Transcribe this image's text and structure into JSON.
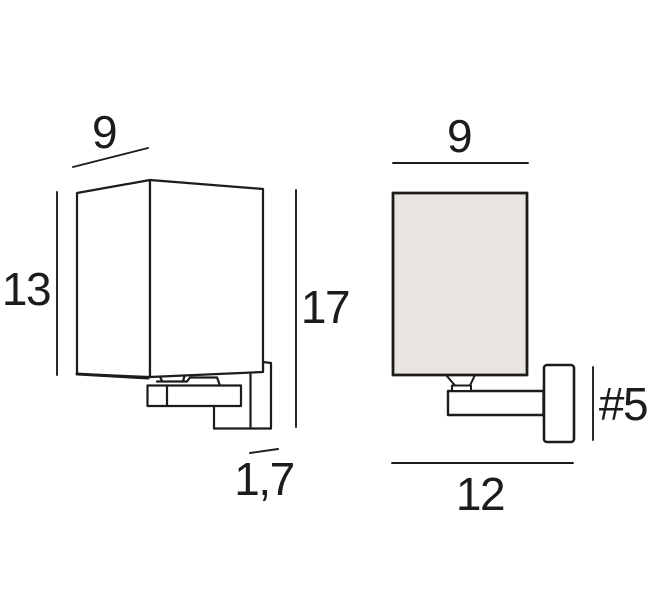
{
  "diagram": {
    "type": "wall-lamp-dimension-drawing",
    "views": {
      "perspective_view": "left",
      "front_view": "right"
    },
    "labels": {
      "side_width": "9",
      "shade_height": "13",
      "total_height": "17",
      "bottom_depth": "1,7",
      "front_width": "9",
      "total_depth": "12",
      "plate_size": "#5"
    },
    "colors": {
      "background": "#ffffff",
      "line": "#1c1c1c",
      "shade_fill": "#e8e5e1",
      "text": "#1c1c1c"
    }
  }
}
